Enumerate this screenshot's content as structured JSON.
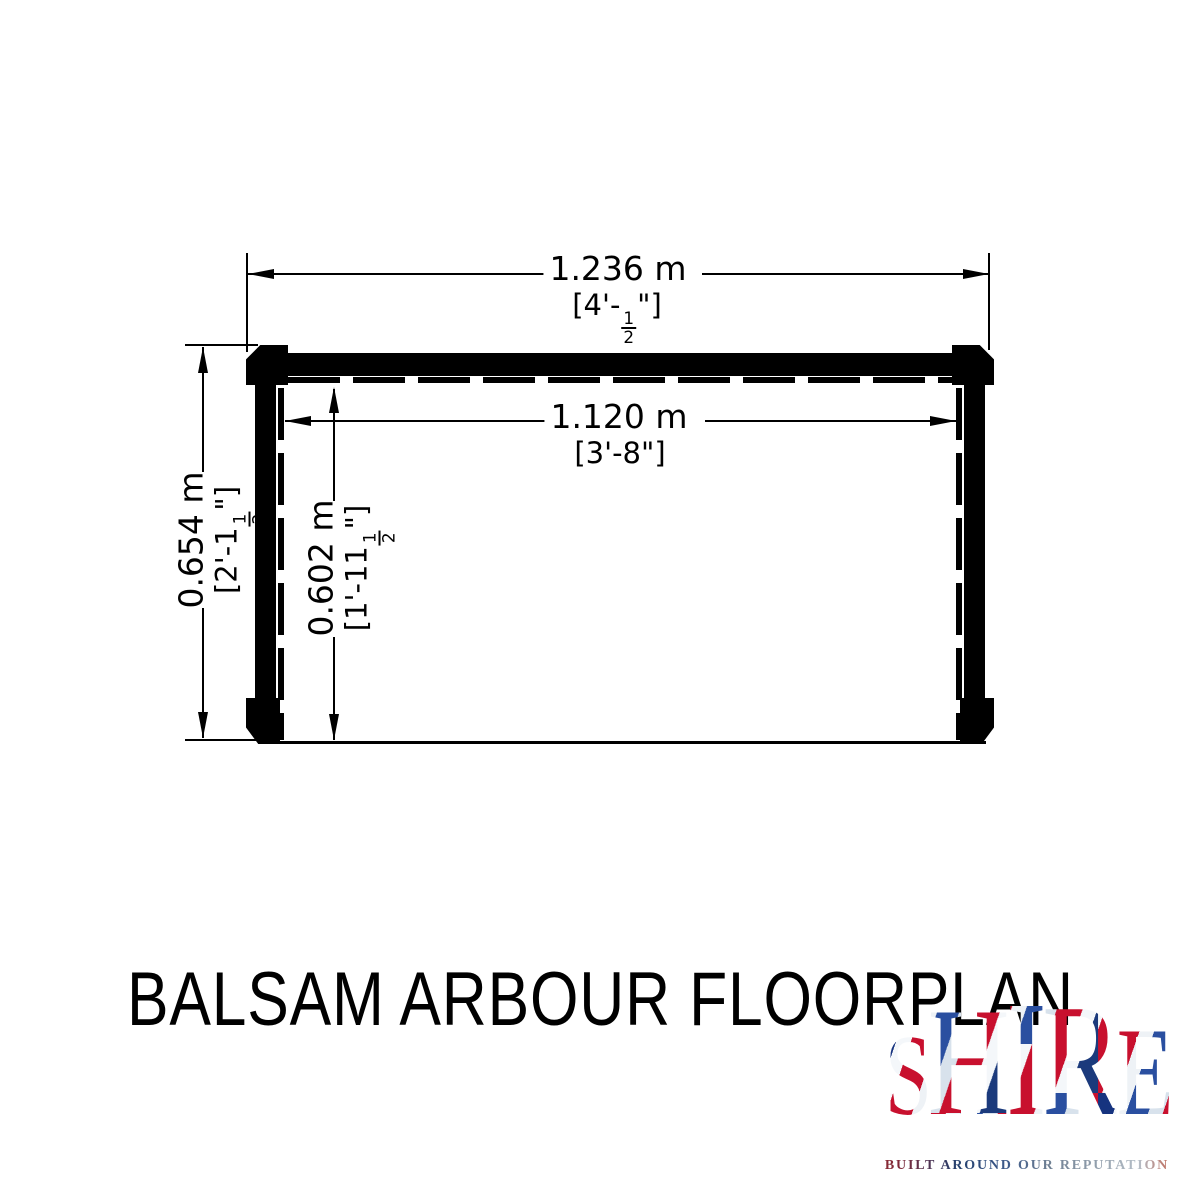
{
  "page": {
    "background": "#ffffff",
    "ink": "#000000"
  },
  "title": "BALSAM ARBOUR FLOORPLAN",
  "floorplan": {
    "overall_width": {
      "metric": "1.236 m",
      "imperial_prefix": "[4'-",
      "fraction_numerator": "1",
      "fraction_denominator": "2",
      "imperial_suffix": "\"]"
    },
    "inner_width": {
      "metric": "1.120 m",
      "imperial": "[3'-8\"]"
    },
    "overall_depth": {
      "metric": "0.654 m",
      "imperial_prefix": "[2'-1",
      "fraction_numerator": "1",
      "fraction_denominator": "2",
      "imperial_suffix": "\"]"
    },
    "inner_depth": {
      "metric": "0.602 m",
      "imperial_prefix": "[1'-11",
      "fraction_numerator": "1",
      "fraction_denominator": "2",
      "imperial_suffix": "\"]"
    }
  },
  "logo": {
    "brand_letters": [
      "S",
      "H",
      "I",
      "R",
      "E"
    ],
    "tagline": "BUILT AROUND OUR REPUTATION",
    "flag_red": "#C8102E",
    "flag_blue": "#012169",
    "flag_white": "#F4F7FA"
  }
}
